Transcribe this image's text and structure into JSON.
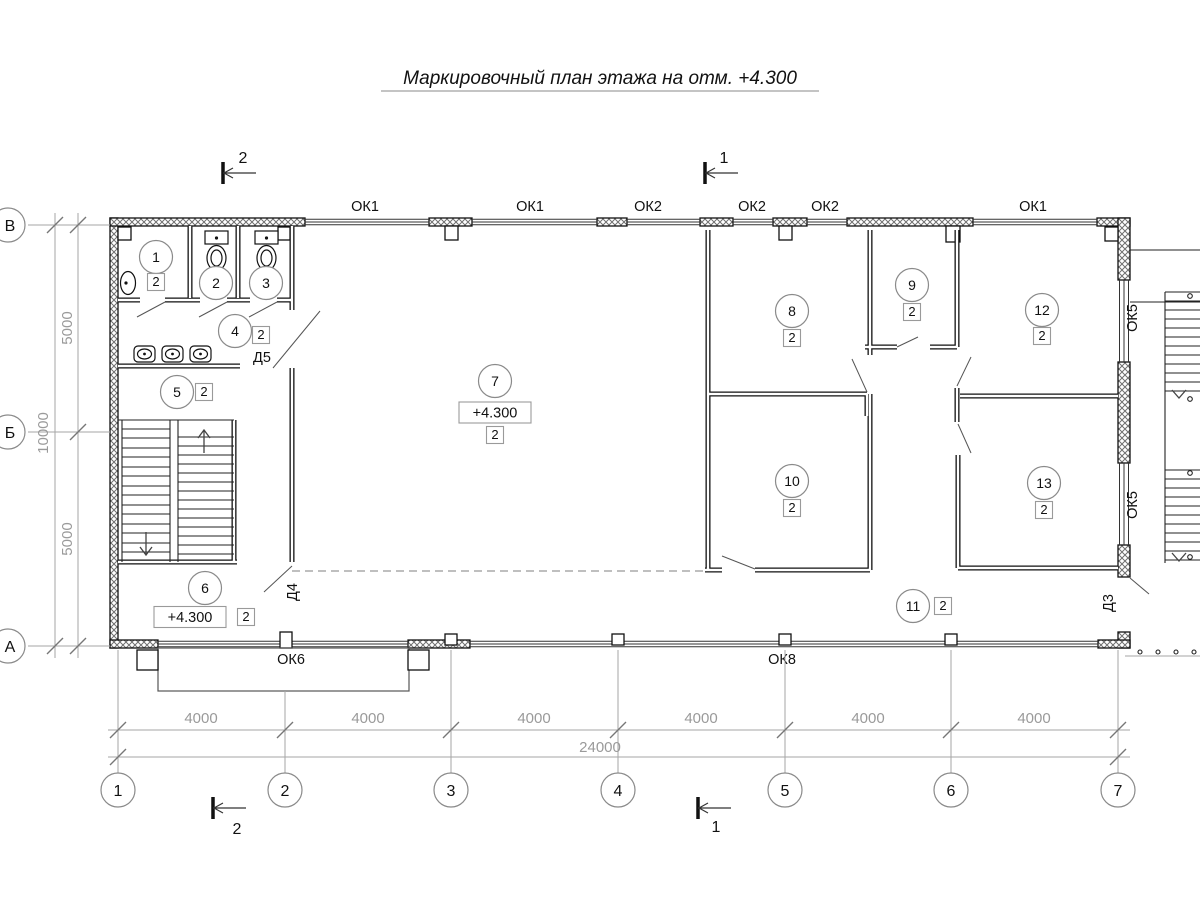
{
  "title": "Маркировочный план этажа на отм. +4.300",
  "rooms": [
    {
      "n": "1",
      "m": "2"
    },
    {
      "n": "2"
    },
    {
      "n": "3"
    },
    {
      "n": "4",
      "m": "2"
    },
    {
      "n": "5",
      "m": "2"
    },
    {
      "n": "6",
      "m": "2",
      "elev": "+4.300"
    },
    {
      "n": "7",
      "m": "2",
      "elev": "+4.300"
    },
    {
      "n": "8",
      "m": "2"
    },
    {
      "n": "9",
      "m": "2"
    },
    {
      "n": "10",
      "m": "2"
    },
    {
      "n": "11",
      "m": "2"
    },
    {
      "n": "12",
      "m": "2"
    },
    {
      "n": "13",
      "m": "2"
    }
  ],
  "windows": {
    "top": [
      "ОК1",
      "ОК1",
      "ОК2",
      "ОК2",
      "ОК2",
      "ОК1"
    ],
    "right": [
      "ОК5",
      "ОК5"
    ],
    "bottom": [
      "ОК6",
      "ОК8"
    ]
  },
  "doors": [
    "Д5",
    "Д4",
    "Д3"
  ],
  "grid": {
    "cols": [
      "1",
      "2",
      "3",
      "4",
      "5",
      "6",
      "7"
    ],
    "rows": [
      "В",
      "Б",
      "А"
    ]
  },
  "dims": {
    "bays": [
      "4000",
      "4000",
      "4000",
      "4000",
      "4000",
      "4000"
    ],
    "total": "24000",
    "left_bays": [
      "5000",
      "5000"
    ],
    "left_total": "10000"
  },
  "sections": {
    "s1": "1",
    "s2": "2"
  }
}
